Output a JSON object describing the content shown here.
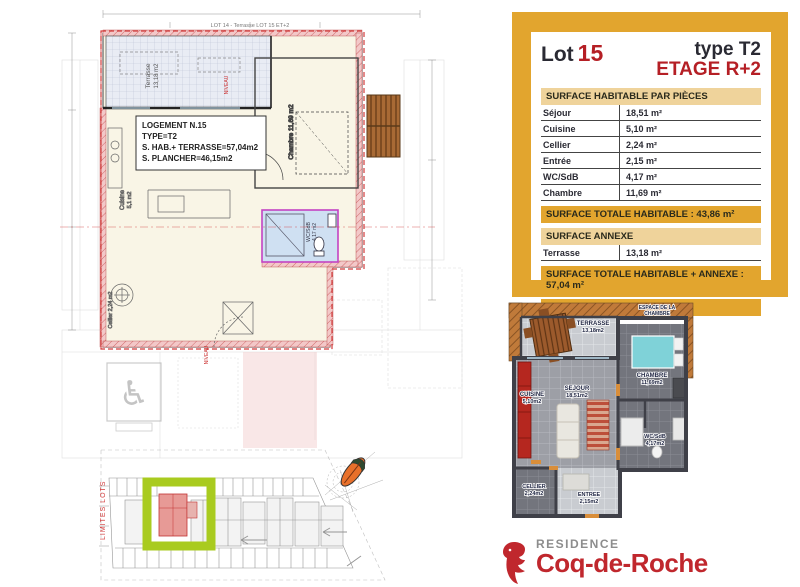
{
  "panel": {
    "lot_label": "Lot",
    "lot_number": "15",
    "type_label": "type T2",
    "etage_label": "ETAGE R+2",
    "table_header": "SURFACE HABITABLE PAR PIÈCES",
    "rooms": [
      {
        "label": "Séjour",
        "value": "18,51 m²"
      },
      {
        "label": "Cuisine",
        "value": "5,10 m²"
      },
      {
        "label": "Cellier",
        "value": "2,24 m²"
      },
      {
        "label": "Entrée",
        "value": "2,15 m²"
      },
      {
        "label": "WC/SdB",
        "value": "4,17 m²"
      },
      {
        "label": "Chambre",
        "value": "11,69 m²"
      }
    ],
    "total_habitable": "SURFACE TOTALE HABITABLE : 43,86 m²",
    "annexe_header": "SURFACE ANNEXE",
    "annexe_row": {
      "label": "Terrasse",
      "value": "13,18 m²"
    },
    "total_hab_annexe": "SURFACE TOTALE HABITABLE + ANNEXE : 57,04 m²",
    "plancher": "SURFACE PLANCHER : 46,15 m²"
  },
  "plan": {
    "top_note": "LOT 14 - Terrasse LOT 15 ET+2",
    "info_box": {
      "line1": "LOGEMENT N.15",
      "line2": "TYPE=T2",
      "line3": "S. HAB.+ TERRASSE=57,04m2",
      "line4": "S. PLANCHER=46,15m2"
    },
    "labels": {
      "terrasse_name": "Terrasse",
      "terrasse_area": "13,18 m2",
      "chambre": "Chambre 11,69 m2",
      "cuisine_name": "Cuisine",
      "cuisine_area": "5,1 m2",
      "cellier": "Cellier 2,24 m2",
      "wc_name": "WC/SdB",
      "wc_area": "4,17 m2",
      "niveau1": "NIVEAU",
      "niveau2": "NIVEAU"
    }
  },
  "site_plan": {
    "limites_label": "LIMITES LOTS"
  },
  "plan3d": {
    "band_line1": "ESPACE DE LA",
    "band_line2": "CHAMBRE",
    "rooms": {
      "terrasse": {
        "name": "TERRASSE",
        "area": "13,18m2"
      },
      "chambre": {
        "name": "CHAMBRE",
        "area": "11,69m2"
      },
      "cuisine": {
        "name": "CUISINE",
        "area": "5,10m2"
      },
      "sejour": {
        "name": "SEJOUR",
        "area": "18,51m2"
      },
      "wc": {
        "name": "WC/SdB",
        "area": "4,17m2"
      },
      "cellier": {
        "name": "CELLIER",
        "area": "2,24m2"
      },
      "entree": {
        "name": "ENTREE",
        "area": "2,15m2"
      }
    }
  },
  "logo": {
    "residence": "RESIDENCE",
    "name": "Coq-de-Roche"
  },
  "colors": {
    "gold": "#e2a52e",
    "tan": "#efd39b",
    "accent_red": "#b51f25",
    "logo_red": "#c0272d",
    "highlight_green": "#a9cb1f",
    "bathroom_blue": "#cfe0f2",
    "plan_cream": "#f9f5e6"
  }
}
